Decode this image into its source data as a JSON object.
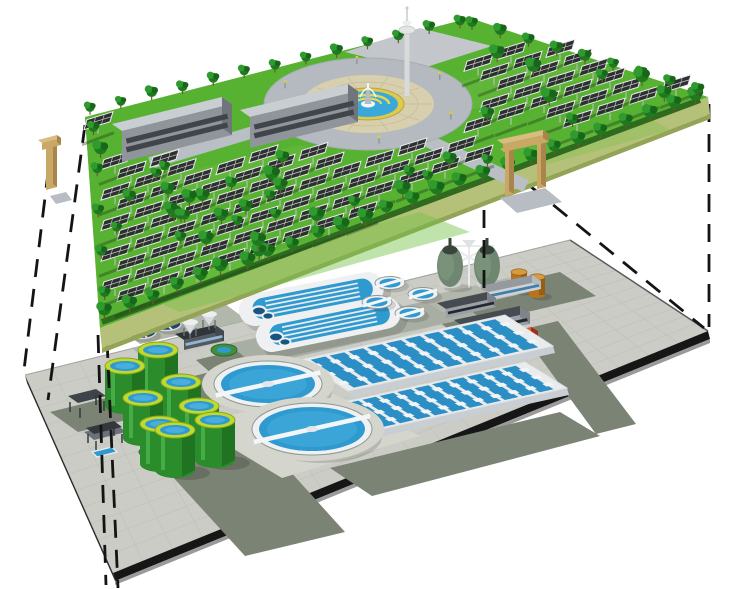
{
  "scene": {
    "description": "Exploded isometric illustration: a landscaped solar park platform suspended above a wastewater treatment plant platform, linked by dashed projection lines",
    "background_color": "#ffffff"
  },
  "upper_layer": {
    "label": "solar-park-platform",
    "palette": {
      "grass": "#58b232",
      "grass_light": "#74c247",
      "skirt": "#b5c178",
      "skirt_shade": "#93a457",
      "skirt_side": "#a3b065",
      "hedge": "#2e6b1f",
      "path": "#b9bfc5",
      "plaza_outer": "#b4bac0",
      "plaza_ring": "#d7cfae",
      "plaza_ring_line": "#c5bb96",
      "pool_rim": "#ddca4e",
      "pool_water": "#3aa9da",
      "fountain_white": "#f5f6f7",
      "statue_gray": "#b9bcbf",
      "tree_dark": "#1f7a1f",
      "tree_light": "#2f9b2f",
      "tree_shade": "#17661a",
      "trunk": "#7a5230",
      "panel_face": "#2d2f31",
      "panel_frame": "#ececec",
      "panel_grid": "#cfcfcf",
      "row_soil": "#1e3f18",
      "post": "#b9bdb9",
      "building_wall": "#8f959b",
      "building_roof": "#c9ced3",
      "building_side": "#6f757b",
      "building_band": "#3f454b",
      "gate_tan": "#c9a765",
      "gate_tan_shade": "#a8854a",
      "ramp_gray": "#b8bdc3",
      "tower_white": "#d9dadb"
    },
    "counts": {
      "solar_panel_rows": 14,
      "panel_spacing_px": 33,
      "office_buildings": 2,
      "entrance_gates": 2,
      "observation_towers": 1,
      "fountain_plazas": 1,
      "trees_front_edge": 26,
      "trees_back_edge": 13,
      "trees_right_edge": 9,
      "trees_left_edge": 5,
      "trees_field": 40,
      "plaza_lamps": 6
    }
  },
  "lower_layer": {
    "label": "treatment-plant-platform",
    "palette": {
      "deck": "#cbccc5",
      "deck_grid": "#bfc0b8",
      "deck_edge_dark": "#161616",
      "deck_edge_light": "#9a9a9a",
      "road": "#7b8374",
      "pad_light": "#d4d5cd",
      "pad_mid": "#a8aea3",
      "pad_back": "#b2b7ac",
      "clarifier_wall": "#eef0f2",
      "clarifier_ring": "#8f9694",
      "water_blue": "#2f9ad0",
      "water_blue_light": "#45aede",
      "water_blue_dark": "#18567f",
      "bridge_white": "#f3f5f7",
      "tank_green": "#2a8c2a",
      "tank_green_dark": "#1e6b1e",
      "tank_green_light": "#4db54d",
      "tank_rim": "#bfd92e",
      "tank_rim_ring": "#8aa51e",
      "digester_body": "#6f8670",
      "digester_light": "#7f957f",
      "digester_top": "#39453a",
      "digester_base": "#cfd3cf",
      "pipe_white": "#e8eaec",
      "orange_tank": "#b5751f",
      "orange_tank_dark": "#8f5a14",
      "orange_tank_top": "#d79a3c",
      "red_building": "#c23b1c",
      "red_building_roof": "#de5a30",
      "navy_tank": "#24456c",
      "navy_tank_light": "#3f74ad",
      "slab_wall": "#9aa0a6",
      "slab_roof": "#454b51",
      "slab_band": "#23282c",
      "blue_band": "#3f7fae",
      "white_slab": "#d5d8da",
      "canopy_dark": "#3f444a",
      "basin_base": "#e9ebec",
      "basin_channel": "#2b8fc6",
      "basin_tab": "#f2f4f5"
    },
    "counts": {
      "green_storage_tanks": 8,
      "large_clarifiers": 2,
      "small_clarifiers": 4,
      "oxidation_ditches": 2,
      "aeration_basin_blocks": 2,
      "channels_per_basin_block": 10,
      "egg_digesters": 2,
      "orange_tanks": 2,
      "gray_service_buildings": 3,
      "dark_service_buildings": 1,
      "white_service_buildings": 1,
      "red_buildings": 1,
      "navy_tanks": 2,
      "hoppers": 2,
      "canopy_structures": 2
    }
  },
  "projection": {
    "line_color": "#141414",
    "dash_pattern": "18 12",
    "line_width": 2.8,
    "left_lines": 4,
    "right_lines": 3
  }
}
